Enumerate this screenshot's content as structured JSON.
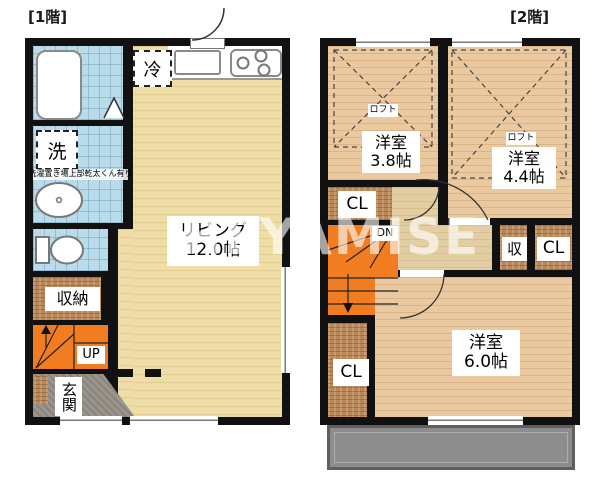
{
  "watermark": "HEYAMISE",
  "floor1": {
    "title": "[1階]",
    "living": {
      "name": "リビング",
      "size": "12.0帖"
    },
    "labels": {
      "fridge": "冷",
      "laundry": "洗",
      "laundry_note": "洗濯置き場上部乾太くん有り",
      "storage": "収納",
      "stairs": "UP",
      "entrance": "玄関"
    }
  },
  "floor2": {
    "title": "[2階]",
    "west_room": {
      "name": "洋室",
      "size": "3.8帖",
      "loft": "ロフト"
    },
    "east_room": {
      "name": "洋室",
      "size": "4.4帖",
      "loft": "ロフト"
    },
    "south_room": {
      "name": "洋室",
      "size": "6.0帖"
    },
    "labels": {
      "closet_mid": "CL",
      "closet_right": "CL",
      "closet_bottom": "CL",
      "storage": "収",
      "stairs": "DN"
    }
  },
  "colors": {
    "wall": "#111111",
    "floor1_wood": "#eedda6",
    "floor2_wood": "#eac9a0",
    "tile_blue": "#badbe9",
    "closet_brown": "#b9885a",
    "stairs_orange": "#f17d20",
    "balcony_gray": "#8d8d8d",
    "entrance_gray": "#9b968d"
  }
}
